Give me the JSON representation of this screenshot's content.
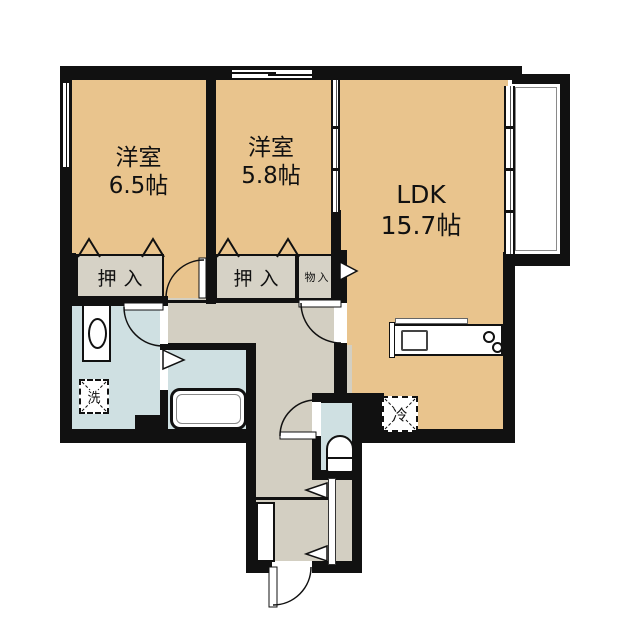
{
  "plan": {
    "rooms": {
      "west_bedroom": {
        "name": "洋室",
        "size": "6.5帖"
      },
      "middle_bedroom": {
        "name": "洋室",
        "size": "5.8帖"
      },
      "ldk": {
        "name": "LDK",
        "size": "15.7帖"
      }
    },
    "storage": {
      "oshiire_west": "押入",
      "oshiire_middle": "押入",
      "monoire": "物入"
    },
    "appliances": {
      "washer": "洗",
      "refrigerator": "冷"
    },
    "colors": {
      "room_tan": "#e9c48d",
      "closet_gray": "#d6d2c6",
      "hall_gray": "#d3cfc2",
      "water_blue": "#cfe0e2",
      "wall_black": "#111111"
    }
  }
}
